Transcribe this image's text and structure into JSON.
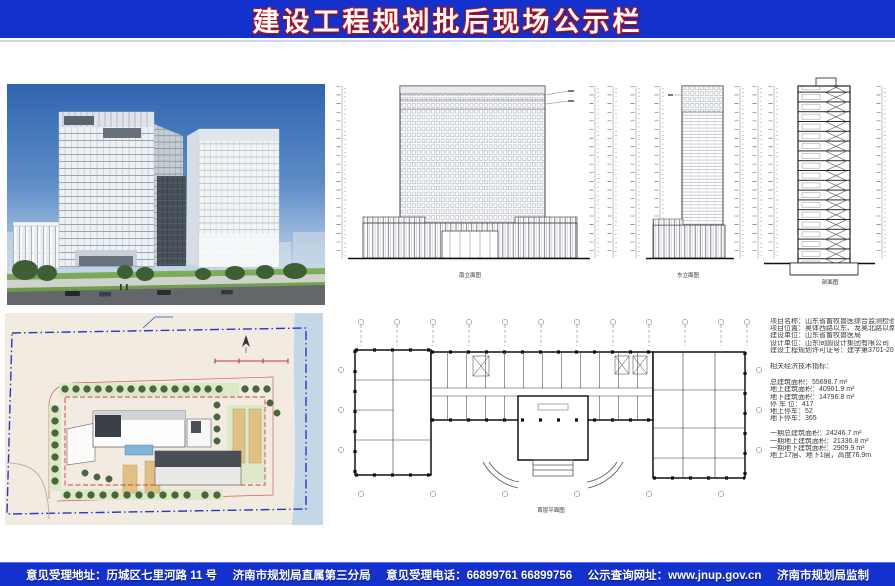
{
  "title": "建设工程规划批后现场公示栏",
  "colors": {
    "bar_blue": "#1331cc",
    "title_glow_red": "#bb0f0f",
    "site_boundary_blue": "#2a35c8",
    "site_red_dashed": "#e03a3a",
    "site_cream": "#f1ebe1",
    "drawing_line": "#444444"
  },
  "drawings": {
    "south_elevation_label": "南立面图",
    "east_elevation_label": "东立面图",
    "section_label": "剖面图",
    "floor_plan_label": "首层平面图"
  },
  "info": {
    "project_lines": [
      "项目名称：山东省畜牧兽医综合监测检验中心",
      "项目位置：奥体西路以东、龙奥北路以南",
      "建设单位：山东省畜牧兽医局",
      "设计单位：山东同圆设计集团有限公司",
      "建设工程规划许可证号：建字第3701-2013066号"
    ],
    "metrics_title": "相关经济技术指标：",
    "metrics": [
      "总建筑面积：55698.7 m²",
      "地上建筑面积：40901.9 m²",
      "地下建筑面积：14796.8 m²",
      "停 车 位：417",
      "地上停车：52",
      "地下停车：365"
    ],
    "phase_metrics": [
      "一期总建筑面积：24246.7 m²",
      "一期地上建筑面积：21336.8 m²",
      "一期地下建筑面积：2909.9 m²",
      "地上17层、地下1层，高度76.9m"
    ]
  },
  "footer": {
    "items": [
      "意见受理地址：历城区七里河路 11 号",
      "济南市规划局直属第三分局",
      "意见受理电话：66899761  66899756",
      "公示查询网址：www.jnup.gov.cn",
      "济南市规划局监制"
    ]
  }
}
